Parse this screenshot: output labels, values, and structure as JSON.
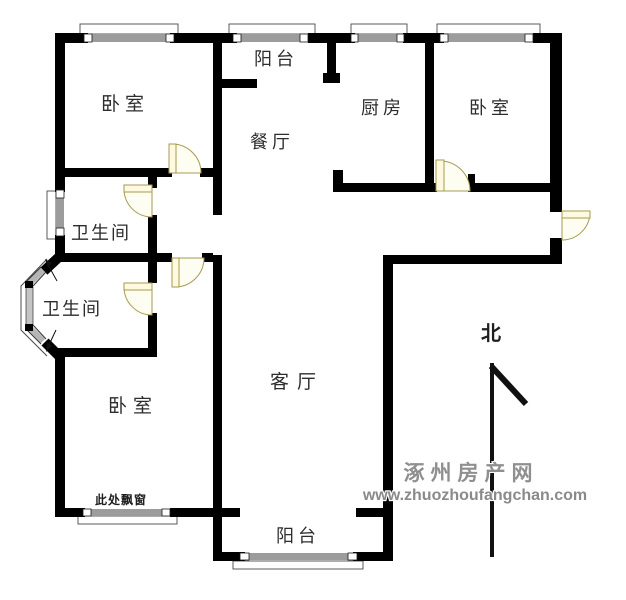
{
  "page": {
    "width": 626,
    "height": 600,
    "background": "#ffffff"
  },
  "palette": {
    "wall": "#000000",
    "window_bar": "#9c9c9c",
    "window_cap_fill": "#ffffff",
    "window_cap_stroke": "#1a1a1a",
    "sill_stroke": "#4a4a4a",
    "door_stroke": "#a89a50",
    "door_leaf_fill": "#fdfadf",
    "door_pie_fill": "#fefdf2",
    "bay_glass": "#b5b5b5",
    "north": "#111111",
    "label": "#2d2d2d",
    "watermark": "#8f8f8f"
  },
  "rooms": [
    {
      "id": "bedroom-top-left",
      "label": "卧室",
      "x": 125,
      "y": 110,
      "size": 19,
      "ls": 5
    },
    {
      "id": "balcony-top",
      "label": "阳台",
      "x": 276,
      "y": 65,
      "size": 18,
      "ls": 4
    },
    {
      "id": "dining-room",
      "label": "餐厅",
      "x": 272,
      "y": 148,
      "size": 18,
      "ls": 4
    },
    {
      "id": "kitchen",
      "label": "厨房",
      "x": 383,
      "y": 114,
      "size": 18,
      "ls": 4
    },
    {
      "id": "bedroom-top-right",
      "label": "卧室",
      "x": 491,
      "y": 114,
      "size": 18,
      "ls": 4
    },
    {
      "id": "bathroom-upper",
      "label": "卫生间",
      "x": 101,
      "y": 239,
      "size": 18,
      "ls": 2
    },
    {
      "id": "bathroom-lower",
      "label": "卫生间",
      "x": 72,
      "y": 315,
      "size": 18,
      "ls": 2
    },
    {
      "id": "living-room",
      "label": "客厅",
      "x": 297,
      "y": 388,
      "size": 19,
      "ls": 8
    },
    {
      "id": "bedroom-bottom",
      "label": "卧室",
      "x": 133,
      "y": 412,
      "size": 19,
      "ls": 6
    },
    {
      "id": "balcony-bottom",
      "label": "阳台",
      "x": 298,
      "y": 542,
      "size": 18,
      "ls": 4
    }
  ],
  "annotations": [
    {
      "id": "bay-window-note",
      "label": "此处飘窗",
      "x": 121,
      "y": 504,
      "size": 12,
      "ls": 1
    },
    {
      "id": "north-label",
      "label": "北",
      "x": 491,
      "y": 340,
      "size": 20,
      "ls": 0
    }
  ],
  "watermark": {
    "line1": "涿州房产网",
    "line2": "www.zhuozhoufangchan.com",
    "x1": 471,
    "y1": 480,
    "size1": 21,
    "ls1": 6,
    "x2": 475,
    "y2": 500,
    "size2": 16,
    "ls2": 0
  },
  "floorplan": {
    "walls": [
      [
        55,
        33,
        10,
        159
      ],
      [
        55,
        235,
        10,
        27
      ],
      [
        55,
        352,
        10,
        165
      ],
      [
        55,
        33,
        33,
        10
      ],
      [
        170,
        33,
        67,
        10
      ],
      [
        308,
        33,
        47,
        10
      ],
      [
        403,
        33,
        41,
        10
      ],
      [
        533,
        33,
        29,
        10
      ],
      [
        550,
        33,
        12,
        179
      ],
      [
        550,
        238,
        12,
        22
      ],
      [
        383,
        255,
        179,
        9
      ],
      [
        383,
        255,
        10,
        306
      ],
      [
        213,
        33,
        9,
        182
      ],
      [
        213,
        255,
        9,
        306
      ],
      [
        55,
        168,
        117,
        9
      ],
      [
        200,
        168,
        22,
        9
      ],
      [
        222,
        79,
        35,
        9
      ],
      [
        327,
        33,
        9,
        50
      ],
      [
        323,
        73,
        17,
        10
      ],
      [
        333,
        170,
        10,
        22
      ],
      [
        333,
        183,
        104,
        9
      ],
      [
        425,
        33,
        9,
        159
      ],
      [
        468,
        183,
        88,
        9
      ],
      [
        468,
        174,
        7,
        9
      ],
      [
        148,
        177,
        9,
        11
      ],
      [
        148,
        215,
        9,
        45
      ],
      [
        55,
        253,
        117,
        9
      ],
      [
        202,
        253,
        11,
        9
      ],
      [
        148,
        262,
        9,
        21
      ],
      [
        148,
        313,
        9,
        44
      ],
      [
        55,
        348,
        102,
        9
      ],
      [
        55,
        508,
        30,
        9
      ],
      [
        170,
        508,
        70,
        9
      ],
      [
        213,
        552,
        32,
        9
      ],
      [
        353,
        552,
        39,
        9
      ],
      [
        356,
        508,
        36,
        9
      ]
    ],
    "windows": [
      {
        "bar": [
          88,
          34,
          82,
          8
        ],
        "caps": [
          [
            84,
            34,
            8,
            8
          ],
          [
            166,
            34,
            8,
            8
          ]
        ],
        "sill": [
          80,
          24,
          98,
          10
        ]
      },
      {
        "bar": [
          237,
          34,
          71,
          8
        ],
        "caps": [
          [
            233,
            34,
            8,
            8
          ],
          [
            300,
            34,
            8,
            8
          ]
        ],
        "sill": [
          229,
          24,
          86,
          10
        ]
      },
      {
        "bar": [
          355,
          34,
          48,
          8
        ],
        "caps": [
          [
            351,
            34,
            7,
            8
          ],
          [
            397,
            34,
            7,
            8
          ]
        ],
        "sill": [
          351,
          24,
          56,
          10
        ]
      },
      {
        "bar": [
          444,
          34,
          89,
          8
        ],
        "caps": [
          [
            440,
            34,
            8,
            8
          ],
          [
            525,
            34,
            8,
            8
          ]
        ],
        "sill": [
          437,
          24,
          103,
          10
        ]
      },
      {
        "bar": [
          56,
          197,
          8,
          31
        ],
        "caps": [
          [
            56,
            190,
            8,
            8
          ],
          [
            56,
            228,
            8,
            8
          ]
        ],
        "sill": [
          47,
          191,
          9,
          48
        ]
      },
      {
        "bar": [
          85,
          509,
          85,
          7
        ],
        "caps": [
          [
            83,
            509,
            8,
            7
          ],
          [
            162,
            509,
            8,
            7
          ]
        ],
        "sill": [
          78,
          516,
          99,
          8
        ]
      },
      {
        "bar": [
          245,
          553,
          108,
          7
        ],
        "caps": [
          [
            240,
            553,
            9,
            7
          ],
          [
            348,
            553,
            9,
            7
          ]
        ],
        "sill": [
          233,
          561,
          130,
          8
        ]
      }
    ],
    "doors": [
      {
        "id": "door-bedroom-top-left",
        "leaf": [
          169,
          144,
          7,
          29
        ],
        "pie": "M172,173 L172,144 A29,29 0 0 1 201,173 Z"
      },
      {
        "id": "door-bathroom-upper",
        "leaf": [
          124,
          185,
          28,
          7
        ],
        "pie": "M152,189 L124,189 A28,28 0 0 0 152,217 Z"
      },
      {
        "id": "door-bathroom-lower",
        "leaf": [
          124,
          283,
          28,
          7
        ],
        "pie": "M152,287 L124,287 A28,28 0 0 0 152,315 Z"
      },
      {
        "id": "door-bedroom-bottom",
        "leaf": [
          172,
          258,
          7,
          29
        ],
        "pie": "M175,258 L175,287 A29,29 0 0 0 204,258 Z"
      },
      {
        "id": "door-bedroom-top-right",
        "leaf": [
          436,
          160,
          8,
          31
        ],
        "pie": "M440,191 L440,161 A30,30 0 0 1 470,191 Z"
      },
      {
        "id": "door-entrance",
        "leaf": [
          562,
          211,
          28,
          7
        ],
        "pie": "M562,212 L590,212 A28,28 0 0 1 562,240 Z"
      }
    ],
    "bay_window": {
      "thick_lines": [
        [
          59,
          257,
          44,
          271,
          10
        ],
        [
          45,
          342,
          59,
          356,
          10
        ]
      ],
      "glass_lines": [
        [
          43,
          270,
          30,
          283,
          6
        ],
        [
          30,
          328,
          43,
          341,
          6
        ]
      ],
      "edge_lines": [
        [
          41,
          267,
          27,
          281,
          1
        ],
        [
          46,
          272,
          33,
          286,
          1
        ],
        [
          27,
          330,
          41,
          344,
          1
        ],
        [
          33,
          325,
          46,
          339,
          1
        ]
      ],
      "vbar": [
        26,
        287,
        7,
        38
      ],
      "vcaps": [
        [
          25,
          281,
          8,
          7
        ],
        [
          25,
          324,
          8,
          7
        ]
      ],
      "sill_path": "M47,259 L21,286 L21,330 L47,356",
      "arrows": [
        {
          "line": [
            57,
            281,
            47,
            263
          ],
          "head": [
            [
              45,
              259
            ],
            [
              52,
              263
            ],
            [
              48,
              268
            ]
          ]
        },
        {
          "line": [
            56,
            330,
            48,
            347
          ],
          "head": [
            [
              46,
              352
            ],
            [
              52,
              346
            ],
            [
              47,
              342
            ]
          ]
        }
      ]
    },
    "north_arrow": {
      "staff": [
        492,
        363,
        492,
        557,
        4
      ],
      "diag": [
        491,
        366,
        526,
        404,
        6
      ]
    }
  }
}
